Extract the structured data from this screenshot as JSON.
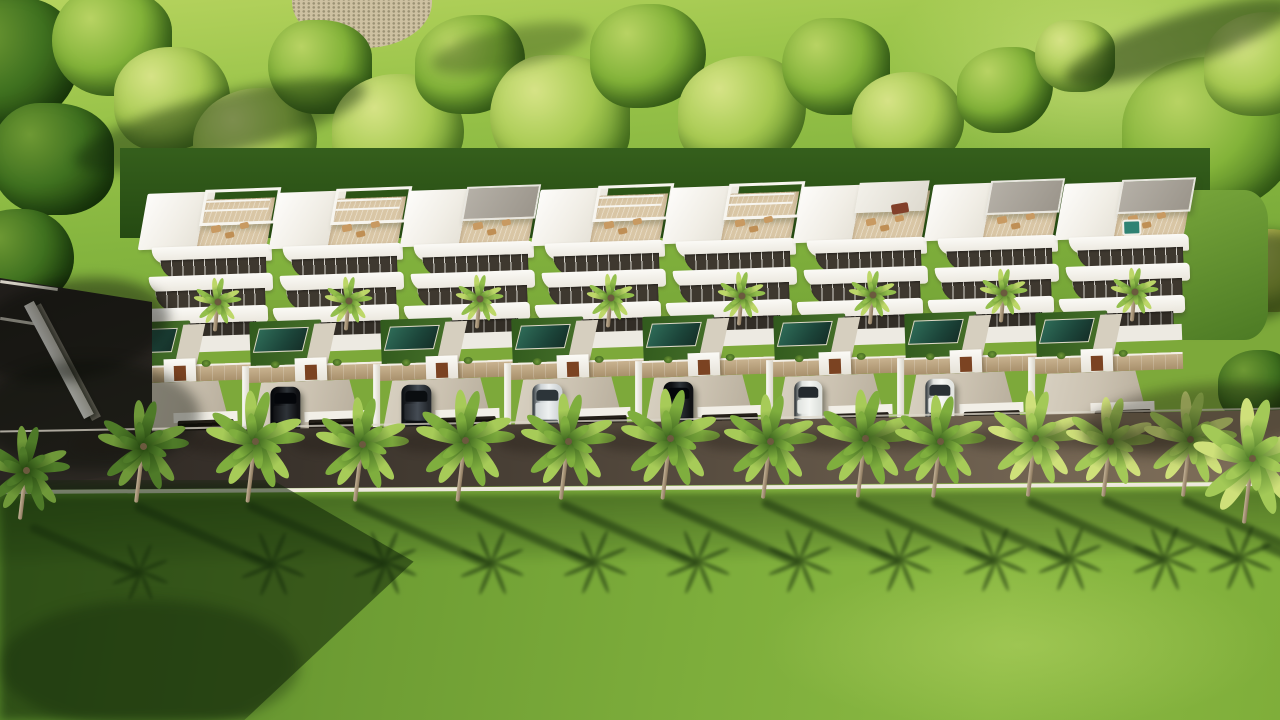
{
  "scene": {
    "width": 1280,
    "height": 720,
    "kind": "aerial-render-of-villa-row"
  },
  "palette": {
    "hill_light": "#b6d35e",
    "hill_mid": "#9ac44a",
    "hill_dark": "#74a436",
    "gravel": "#cec1a2",
    "villa_white": "#f6f4ee",
    "villa_shade": "#e3dfd4",
    "deck_wood": "#d9c6a5",
    "window_glass": "#3e382f",
    "pool_light": "#2e6b57",
    "pool_dark": "#152f28",
    "stone_wall": "#cdb794",
    "entry_door": "#7b4322",
    "drive_light": "#d9d2c3",
    "drive_dark": "#b4aa98",
    "garage_dark": "#16120c",
    "road_dark": "#2c2723",
    "road_light": "#7b6b57",
    "road_line": "#efeade",
    "lawn_bright": "#8ab842",
    "lawn_mid": "#6d9c33",
    "lawn_shadow": "#2e501c",
    "trunk": "#b5a186"
  },
  "hill": {
    "gravel": {
      "x": 292,
      "y": -6,
      "w": 140,
      "h": 54
    }
  },
  "trees": [
    {
      "x": 8,
      "y": 70,
      "r": 72,
      "t": "dark"
    },
    {
      "x": 52,
      "y": 165,
      "r": 62,
      "t": "dark"
    },
    {
      "x": 18,
      "y": 265,
      "r": 56,
      "t": "dark"
    },
    {
      "x": 58,
      "y": 345,
      "r": 48,
      "t": "dark"
    },
    {
      "x": 112,
      "y": 48,
      "r": 60,
      "t": "mid"
    },
    {
      "x": 172,
      "y": 105,
      "r": 58,
      "t": "light"
    },
    {
      "x": 255,
      "y": 150,
      "r": 62,
      "t": "light"
    },
    {
      "x": 320,
      "y": 72,
      "r": 52,
      "t": "mid"
    },
    {
      "x": 398,
      "y": 140,
      "r": 66,
      "t": "light"
    },
    {
      "x": 470,
      "y": 70,
      "r": 55,
      "t": "mid"
    },
    {
      "x": 560,
      "y": 125,
      "r": 70,
      "t": "light"
    },
    {
      "x": 648,
      "y": 62,
      "r": 58,
      "t": "mid"
    },
    {
      "x": 742,
      "y": 120,
      "r": 64,
      "t": "light"
    },
    {
      "x": 836,
      "y": 72,
      "r": 54,
      "t": "mid"
    },
    {
      "x": 908,
      "y": 128,
      "r": 56,
      "t": "light"
    },
    {
      "x": 1005,
      "y": 95,
      "r": 48,
      "t": "mid"
    },
    {
      "x": 1075,
      "y": 60,
      "r": 40,
      "t": "light"
    },
    {
      "x": 1210,
      "y": 145,
      "r": 88,
      "t": "mid"
    },
    {
      "x": 1262,
      "y": 70,
      "r": 58,
      "t": "light"
    },
    {
      "x": 1268,
      "y": 275,
      "r": 46,
      "t": "gold"
    },
    {
      "x": 1258,
      "y": 390,
      "r": 40,
      "t": "dark"
    },
    {
      "x": 210,
      "y": 205,
      "r": 30,
      "t": "dark"
    },
    {
      "x": 620,
      "y": 200,
      "r": 28,
      "t": "dark"
    },
    {
      "x": 980,
      "y": 195,
      "r": 26,
      "t": "dark"
    }
  ],
  "hill_shadows": [
    {
      "x": 70,
      "y": 95,
      "w": 300,
      "h": 60,
      "rot": -14,
      "op": 0.45
    },
    {
      "x": 1060,
      "y": 16,
      "w": 240,
      "h": 50,
      "rot": -18,
      "op": 0.5
    },
    {
      "x": 1140,
      "y": 235,
      "w": 190,
      "h": 90,
      "rot": -12,
      "op": 0.55
    },
    {
      "x": 430,
      "y": 28,
      "w": 160,
      "h": 40,
      "rot": -12,
      "op": 0.3
    }
  ],
  "backdrop": {
    "x": 120,
    "y": 148,
    "w": 1090,
    "h": 90
  },
  "grass_gap": {
    "x": 1148,
    "y": 190,
    "w": 120,
    "h": 150
  },
  "villas": {
    "top": 186,
    "items": [
      {
        "x": 148,
        "dy": 0,
        "pergola": "frame",
        "car": null
      },
      {
        "x": 279,
        "dy": -1,
        "pergola": "frame",
        "car": "black"
      },
      {
        "x": 410,
        "dy": -3,
        "pergola": "gray",
        "car": "darkgray"
      },
      {
        "x": 541,
        "dy": -4,
        "pergola": "frame",
        "car": "silver"
      },
      {
        "x": 672,
        "dy": -6,
        "pergola": "frame",
        "car": "black"
      },
      {
        "x": 803,
        "dy": -7,
        "pergola": "white",
        "car": "whitevan",
        "sofa": true
      },
      {
        "x": 934,
        "dy": -9,
        "pergola": "gray",
        "car": "white"
      },
      {
        "x": 1065,
        "dy": -10,
        "pergola": "gray",
        "car": null,
        "jacuzzi": true
      }
    ]
  },
  "cars": {
    "black": {
      "body": "#101114",
      "roof": "#2e3338",
      "glass": "#04060a",
      "w": 30,
      "h": 52
    },
    "darkgray": {
      "body": "#23272c",
      "roof": "#454c54",
      "glass": "#0a0d10",
      "w": 30,
      "h": 52
    },
    "silver": {
      "body": "#ced3d5",
      "roof": "#eef1f1",
      "glass": "#2c3439",
      "w": 30,
      "h": 52
    },
    "white": {
      "body": "#e3e5e1",
      "roof": "#f7f8f6",
      "glass": "#2a3135",
      "w": 29,
      "h": 50
    },
    "whitevan": {
      "body": "#dfe2de",
      "roof": "#f4f6f3",
      "glass": "#23292d",
      "w": 28,
      "h": 46
    }
  },
  "road": {
    "top_left": 434,
    "top_right": 410,
    "bottom_left": 492,
    "bottom_right": 483
  },
  "access_road": {
    "x": 0,
    "y": 276,
    "w": 154,
    "h": 220,
    "lines": [
      {
        "x": 0,
        "y": 284,
        "w": 58,
        "rot": 8
      },
      {
        "x": 0,
        "y": 320,
        "w": 40,
        "rot": 9
      }
    ]
  },
  "perimeter_wall": {
    "x": 24,
    "y": 306,
    "w": 11,
    "h": 128,
    "rot": -28
  },
  "palm_tones": {
    "dark": [
      "#6f9839",
      "#4e7a28",
      "#24450f"
    ],
    "mid": [
      "#a7cb58",
      "#7fae3e",
      "#39611d"
    ],
    "light": [
      "#cfe07a",
      "#a3c957",
      "#4d7a27"
    ],
    "yard": [
      "#bdd768",
      "#93bf4c",
      "#477022"
    ]
  },
  "road_palms": [
    {
      "x": 133,
      "size": 46,
      "tone": "dark"
    },
    {
      "x": 245,
      "size": 50,
      "tone": "mid"
    },
    {
      "x": 352,
      "size": 47,
      "tone": "mid"
    },
    {
      "x": 455,
      "size": 50,
      "tone": "mid"
    },
    {
      "x": 558,
      "size": 48,
      "tone": "mid"
    },
    {
      "x": 660,
      "size": 50,
      "tone": "mid"
    },
    {
      "x": 760,
      "size": 47,
      "tone": "mid"
    },
    {
      "x": 855,
      "size": 49,
      "tone": "mid"
    },
    {
      "x": 930,
      "size": 46,
      "tone": "mid"
    },
    {
      "x": 1025,
      "size": 48,
      "tone": "light"
    },
    {
      "x": 1100,
      "size": 45,
      "tone": "light"
    },
    {
      "x": 1180,
      "size": 47,
      "tone": "light"
    }
  ],
  "lawn_palms": [
    {
      "x": 26,
      "cy": 470,
      "size": 44,
      "tone": "dark"
    }
  ],
  "edge_palm": {
    "cx": 1252,
    "cy": 458,
    "size": 60,
    "tone": "light"
  },
  "lawn": {
    "left_shadow_w": 470,
    "shadow_band": {
      "y": 494,
      "h": 70
    },
    "highlight": {
      "x": 760,
      "y": 560,
      "w": 520,
      "h": 170
    }
  }
}
